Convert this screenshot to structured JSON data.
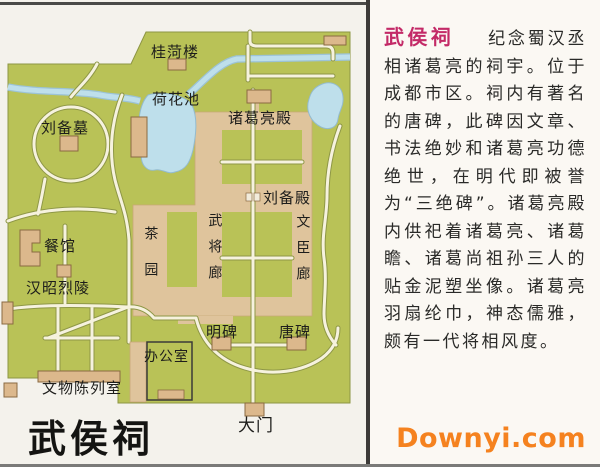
{
  "map": {
    "title": "武侯祠",
    "labels": {
      "gui_he_lou": "桂菏楼",
      "he_hua_chi": "荷花池",
      "liu_bei_mu": "刘备墓",
      "zhuge_liang_dian": "诸葛亮殿",
      "liu_bei_dian": "刘备殿",
      "cha_yuan": "茶园",
      "wu_jiang_lang": "武将廊",
      "wen_chen_lang": "文臣廊",
      "can_guan": "餐馆",
      "han_zhao_lie_ling": "汉昭烈陵",
      "ming_bei": "明碑",
      "tang_bei": "唐碑",
      "ban_gong_shi": "办公室",
      "wen_wu_chen_lie_shi": "文物陈列室",
      "da_men": "大门"
    }
  },
  "panel": {
    "title": "武侯祠",
    "body": "纪念蜀汉丞相诸葛亮的祠宇。位于成都市区。祠内有著名的唐碑，此碑因文章、书法绝妙和诸葛亮功德绝世，在明代即被誉为“三绝碑”。诸葛亮殿内供祀着诸葛亮、诸葛瞻、诸葛尚祖孙三人的贴金泥塑坐像。诸葛亮羽扇纶巾，神态儒雅，颇有一代将相风度。"
  },
  "watermark": "Downyi.com",
  "colors": {
    "map_green": "#b9c257",
    "complex_tan": "#dfc49c",
    "building_tan": "#dcb88c",
    "water_blue": "#bedfeb",
    "road_cream": "#f6f2de",
    "title_magenta": "#c32a67",
    "watermark_orange": "#f5821f"
  }
}
